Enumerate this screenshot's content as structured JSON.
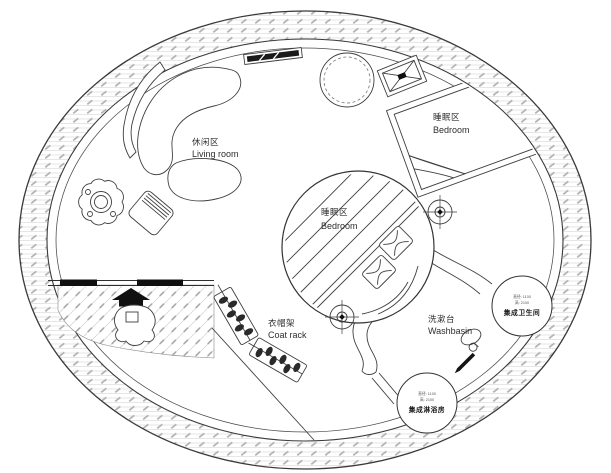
{
  "labels": {
    "living_room": {
      "zh": "休闲区",
      "en": "Living room"
    },
    "bedroom_upper": {
      "zh": "睡眠区",
      "en": "Bedroom"
    },
    "bedroom_center": {
      "zh": "睡眠区",
      "en": "Bedroom"
    },
    "coat_rack": {
      "zh": "衣帽架",
      "en": "Coat rack"
    },
    "washbasin": {
      "zh": "洗漱台",
      "en": "Washbasin"
    },
    "bathroom": {
      "spec1": "直径: 1100",
      "spec2": "高: 2100",
      "name": "集成卫生间"
    },
    "shower": {
      "spec1": "直径: 1100",
      "spec2": "高: 2100",
      "name": "集成淋浴房"
    }
  },
  "icons": {
    "plant": "plant-icon",
    "armchair": "armchair-icon",
    "stove": "stove-icon",
    "round_table": "round-table-icon",
    "ceiling_vent": "vent-box-icon",
    "axis_target": "crosshair-icon",
    "coat_rack": "coat-rack-icon",
    "marker_pen": "pen-icon",
    "lasso": "lasso-icon"
  },
  "colors": {
    "line": "#3a3a3a",
    "hatch_line": "#dedede",
    "hatch_dash": "#b3b3b3",
    "deck_line": "#cfcfcf",
    "black_fill": "#101010",
    "text": "#2e2e2e"
  }
}
